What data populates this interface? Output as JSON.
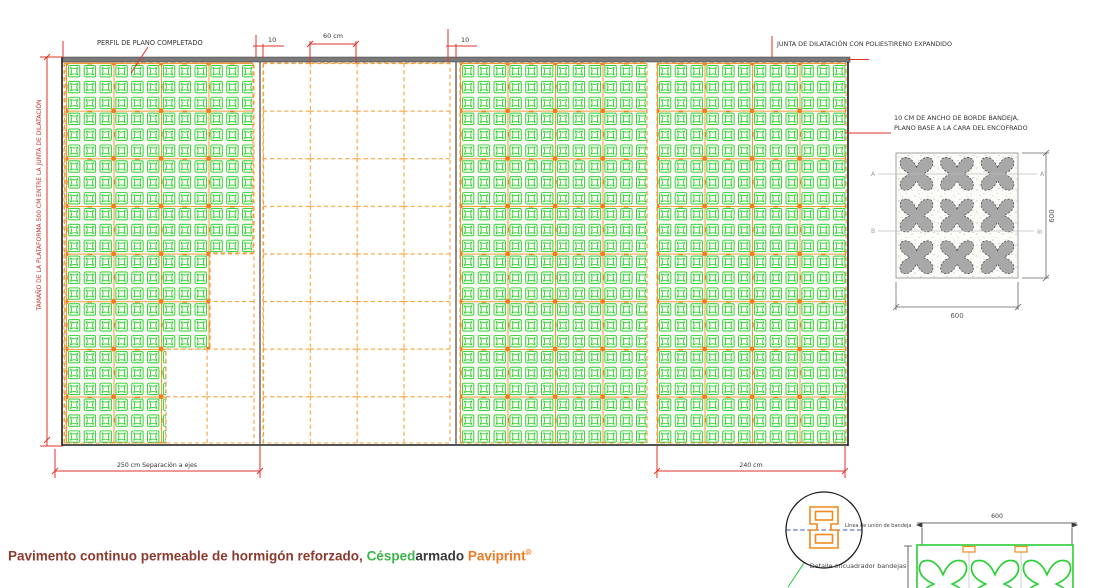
{
  "colors": {
    "paver_green": "#29cf35",
    "tray_orange": "#ef8a24",
    "dash_orange": "#f2a440",
    "dim_red": "#e23127",
    "structure_black": "#1b1b1b",
    "bar_gray": "#7a7a7a",
    "paver_gray": "#a8a8a8",
    "title_brown": "#8e3b2f",
    "brand_green": "#3cb54a",
    "brand_orange": "#f07822"
  },
  "plan": {
    "label_perfil": "PERFIL DE PLANO COMPLETADO",
    "label_junta": "JUNTA DE DILATACIÓN CON POLIESTIRENO EXPANDIDO",
    "label_plataforma": "TAMAÑO DE LA PLATAFORMA 500 CM ENTRE LA JUNTA DE DILATACIÓN",
    "label_borde_1": "10 CM DE ANCHO DE BORDE BANDEJA,",
    "label_borde_2": "PLANO BASE A LA CARA DEL ENCOFRADO",
    "dim_joint_left": "10",
    "dim_tray": "60 cm",
    "dim_joint_right": "10",
    "dim_separacion": "250 cm Separación a ejes",
    "dim_campo": "240 cm"
  },
  "detail_top": {
    "label_a": "A",
    "label_a2": "A'",
    "label_b": "B",
    "label_b2": "B'",
    "dim_height": "600",
    "dim_width": "600"
  },
  "detail_bottom": {
    "linea": "Línea de unión de bandeja",
    "caption": "Detalle encuadrador bandejas",
    "dim": "600"
  },
  "footer": {
    "text": "Pavimento continuo permeable de hormigón reforzado, ",
    "brand_green": "Césped",
    "brand_dark": "armado",
    "brand_orange": "Paviprint",
    "reg": "®"
  }
}
